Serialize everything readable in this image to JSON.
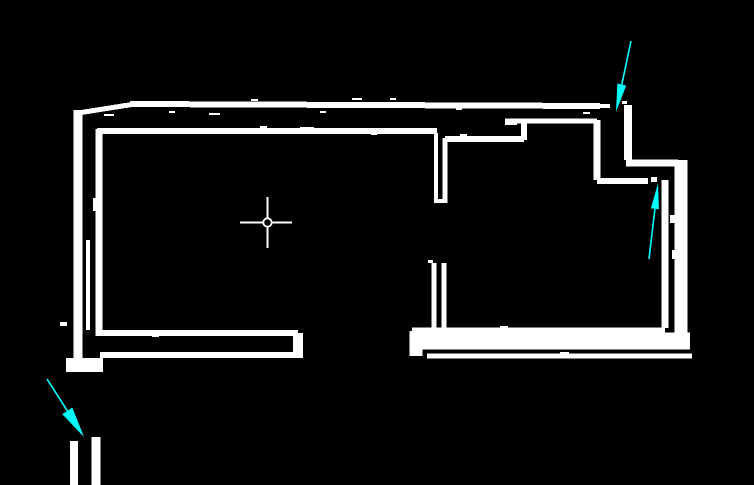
{
  "canvas": {
    "width": 754,
    "height": 485,
    "background": "#000000"
  },
  "colors": {
    "wall": "#ffffff",
    "annotation_arrow": "#00ffff",
    "crosshair": "#ffffff"
  },
  "map": {
    "walls": [
      {
        "x1": 78,
        "y1": 113,
        "x2": 135,
        "y2": 104,
        "w": 5
      },
      {
        "x1": 130,
        "y1": 104,
        "x2": 600,
        "y2": 106,
        "w": 6
      },
      {
        "x1": 78,
        "y1": 110,
        "x2": 78,
        "y2": 364,
        "w": 9
      },
      {
        "x1": 66,
        "y1": 365,
        "x2": 103,
        "y2": 365,
        "w": 14
      },
      {
        "x1": 100,
        "y1": 355,
        "x2": 303,
        "y2": 355,
        "w": 6
      },
      {
        "x1": 298,
        "y1": 333,
        "x2": 298,
        "y2": 357,
        "w": 10
      },
      {
        "x1": 100,
        "y1": 333,
        "x2": 298,
        "y2": 333,
        "w": 6
      },
      {
        "x1": 99,
        "y1": 129,
        "x2": 99,
        "y2": 336,
        "w": 7
      },
      {
        "x1": 97,
        "y1": 131,
        "x2": 437,
        "y2": 131,
        "w": 6
      },
      {
        "x1": 436,
        "y1": 133,
        "x2": 436,
        "y2": 203,
        "w": 4
      },
      {
        "x1": 445,
        "y1": 138,
        "x2": 445,
        "y2": 203,
        "w": 5
      },
      {
        "x1": 434,
        "y1": 263,
        "x2": 434,
        "y2": 331,
        "w": 5
      },
      {
        "x1": 444,
        "y1": 263,
        "x2": 444,
        "y2": 328,
        "w": 5
      },
      {
        "x1": 445,
        "y1": 139,
        "x2": 524,
        "y2": 139,
        "w": 6
      },
      {
        "x1": 524,
        "y1": 120,
        "x2": 524,
        "y2": 140,
        "w": 6
      },
      {
        "x1": 505,
        "y1": 121,
        "x2": 597,
        "y2": 121,
        "w": 5
      },
      {
        "x1": 597,
        "y1": 120,
        "x2": 597,
        "y2": 180,
        "w": 7
      },
      {
        "x1": 597,
        "y1": 181,
        "x2": 648,
        "y2": 181,
        "w": 6
      },
      {
        "x1": 665,
        "y1": 180,
        "x2": 665,
        "y2": 328,
        "w": 7
      },
      {
        "x1": 628,
        "y1": 105,
        "x2": 628,
        "y2": 160,
        "w": 8
      },
      {
        "x1": 626,
        "y1": 163,
        "x2": 678,
        "y2": 163,
        "w": 7
      },
      {
        "x1": 681,
        "y1": 160,
        "x2": 681,
        "y2": 348,
        "w": 13
      },
      {
        "x1": 412,
        "y1": 330,
        "x2": 665,
        "y2": 330,
        "w": 5
      },
      {
        "x1": 418,
        "y1": 341,
        "x2": 690,
        "y2": 341,
        "w": 17
      },
      {
        "x1": 427,
        "y1": 356,
        "x2": 692,
        "y2": 356,
        "w": 5
      },
      {
        "x1": 416,
        "y1": 331,
        "x2": 416,
        "y2": 356,
        "w": 13
      },
      {
        "x1": 74,
        "y1": 441,
        "x2": 74,
        "y2": 485,
        "w": 8
      },
      {
        "x1": 96,
        "y1": 437,
        "x2": 96,
        "y2": 485,
        "w": 9
      }
    ],
    "speckles": [
      [
        104,
        114,
        10,
        2
      ],
      [
        209,
        113,
        11,
        2
      ],
      [
        60,
        322,
        7,
        4
      ],
      [
        86,
        240,
        4,
        90
      ],
      [
        93,
        198,
        4,
        13
      ],
      [
        505,
        123,
        12,
        2
      ],
      [
        352,
        98,
        10,
        2
      ],
      [
        600,
        104,
        10,
        4
      ],
      [
        169,
        111,
        6,
        2
      ],
      [
        251,
        99,
        7,
        2
      ],
      [
        320,
        111,
        6,
        2
      ],
      [
        390,
        98,
        6,
        2
      ],
      [
        456,
        108,
        6,
        2
      ],
      [
        583,
        112,
        7,
        2
      ],
      [
        460,
        134,
        7,
        2
      ],
      [
        260,
        126,
        7,
        2
      ],
      [
        300,
        127,
        14,
        3
      ],
      [
        371,
        133,
        6,
        2
      ],
      [
        622,
        101,
        5,
        3
      ],
      [
        500,
        326,
        8,
        2
      ],
      [
        560,
        352,
        9,
        2
      ],
      [
        220,
        356,
        8,
        2
      ],
      [
        152,
        335,
        7,
        2
      ],
      [
        438,
        199,
        5,
        4
      ],
      [
        428,
        260,
        5,
        3
      ],
      [
        651,
        177,
        6,
        5
      ],
      [
        670,
        215,
        6,
        8
      ],
      [
        672,
        250,
        6,
        9
      ]
    ]
  },
  "crosshair": {
    "cx": 267.5,
    "cy": 222.5,
    "left": 240,
    "right": 292,
    "top": 197,
    "bottom": 248,
    "line_width": 1.6,
    "circle_radius": 4.2,
    "circle_stroke": 1.8
  },
  "arrows": [
    {
      "id": "top-right",
      "tail": [
        631,
        41
      ],
      "tip": [
        616,
        112
      ],
      "head_length": 28,
      "head_width": 9,
      "line_width": 1.6
    },
    {
      "id": "right-middle",
      "tail": [
        649,
        259
      ],
      "tip": [
        658,
        183
      ],
      "head_length": 26,
      "head_width": 8,
      "line_width": 1.6
    },
    {
      "id": "bottom-left",
      "tail": [
        47,
        379
      ],
      "tip": [
        84,
        437
      ],
      "head_length": 31,
      "head_width": 12,
      "line_width": 1.6
    }
  ]
}
